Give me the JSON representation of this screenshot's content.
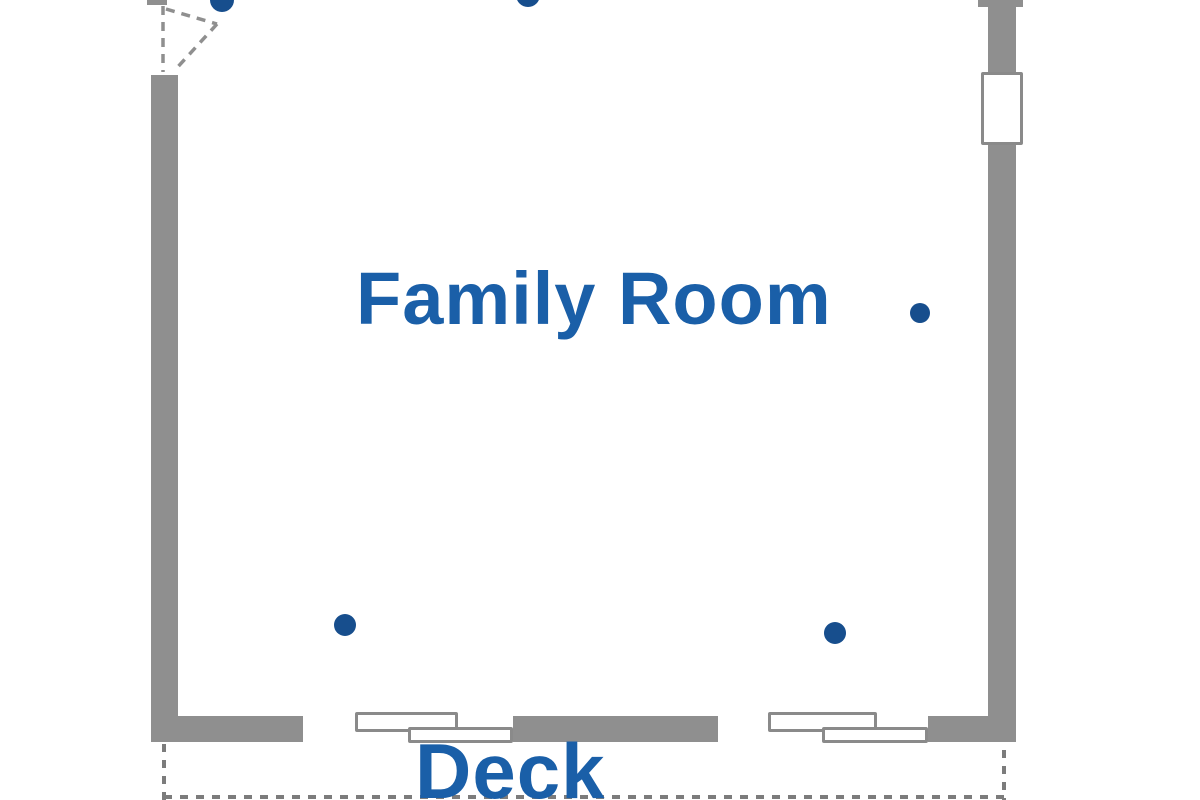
{
  "labels": {
    "room": "Family Room",
    "area": "Deck"
  },
  "colors": {
    "background": "#ffffff",
    "wall": "#8f8f8f",
    "window_border": "#8a8a8a",
    "window_fill": "#ffffff",
    "label_text": "#1a5fa8",
    "dot": "#174e8d",
    "deck_outline": "#7c7c7c"
  },
  "fixtures": {
    "door": "hinged-door-swing-top-left",
    "windows": [
      "window-right-wall",
      "sliding-window-bottom-left",
      "sliding-window-bottom-right"
    ],
    "dot_marker_count": 5
  }
}
